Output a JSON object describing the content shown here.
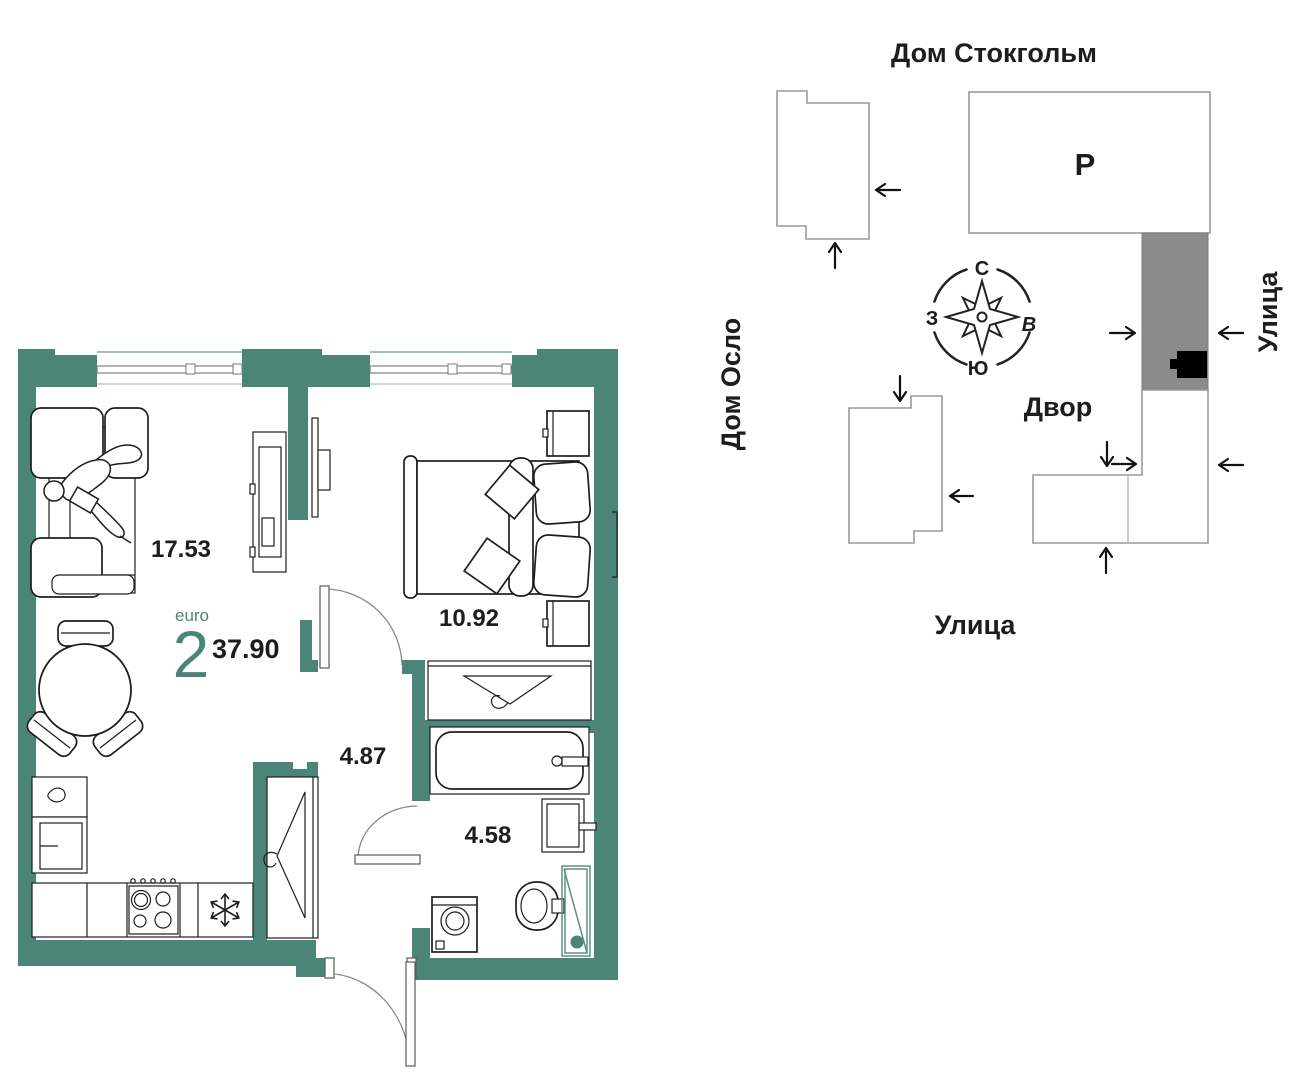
{
  "floor_plan": {
    "unit_type_label": "euro",
    "unit_rooms": "2",
    "unit_area": "37.90",
    "room_areas": {
      "living_kitchen": "17.53",
      "bedroom": "10.92",
      "hallway": "4.87",
      "bathroom": "4.58"
    }
  },
  "site_plan": {
    "title": "Дом Стокгольм",
    "building_left": "Дом Осло",
    "street_right": "Улица",
    "street_bottom": "Улица",
    "courtyard": "Двор",
    "parking": "Р",
    "compass": {
      "n": "С",
      "e": "В",
      "s": "Ю",
      "w": "З"
    }
  },
  "colors": {
    "wall_teal": "#4a8577",
    "building_gray": "#8b8b8b",
    "marker_black": "#000000"
  }
}
